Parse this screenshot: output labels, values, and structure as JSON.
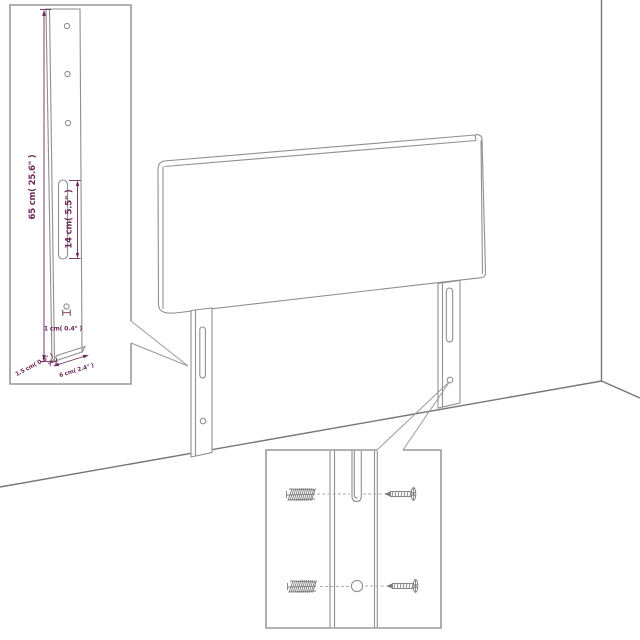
{
  "scene": {
    "description": "Line-art assembly diagram of an upholstered headboard with two slotted mounting legs, shown against a room corner, with two magnified callout insets",
    "main_view": "headboard panel with two legs",
    "room_elements": [
      "wall corner line",
      "floor lines"
    ]
  },
  "callouts": {
    "leg_side_view": {
      "dimensions": {
        "leg_height": "65 cm( 25.6\" )",
        "slot_length": "14 cm( 5.5\" )",
        "hole_diameter": "1 cm( 0.4\" )",
        "leg_thickness": "1.5 cm( 0.6\" )",
        "leg_depth": "6 cm( 2.4\" )"
      },
      "features": [
        "three round holes",
        "long vertical slot",
        "small hole near bottom"
      ]
    },
    "fastener_detail": {
      "features": [
        "slot close-up",
        "round hole close-up",
        "two threaded anchor bolts",
        "two screws"
      ]
    }
  },
  "colors": {
    "dimension_annotation": "#6d2a5c",
    "drawing_line": "#8f8f8f",
    "room_line": "#767676",
    "inset_border": "#9a9a9a",
    "background": "#ffffff"
  }
}
